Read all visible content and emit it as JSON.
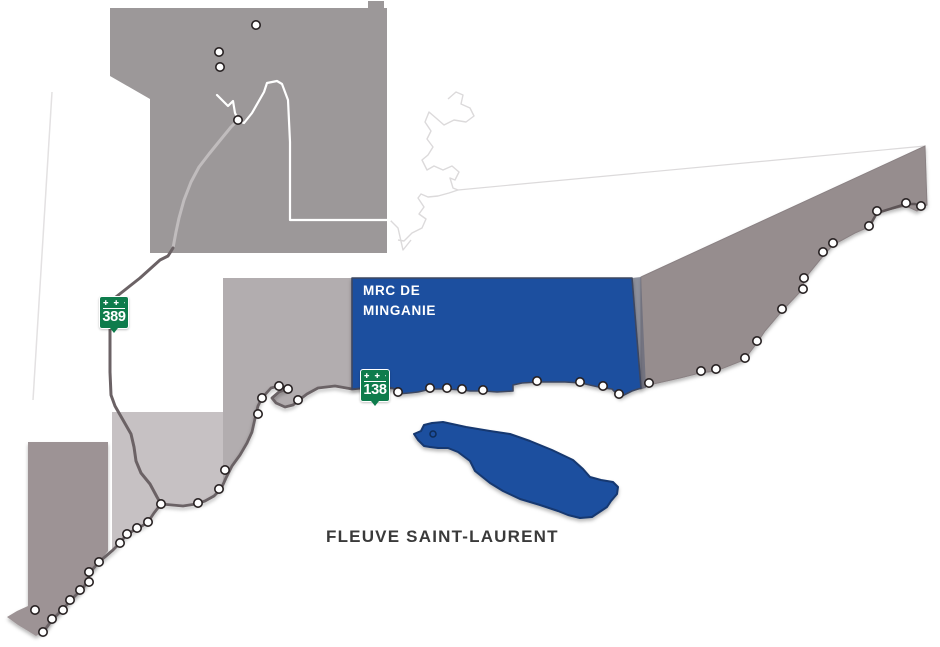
{
  "labels": {
    "region_line1": "MRC DE",
    "region_line2": "MINGANIE",
    "river": "FLEUVE SAINT-LAURENT"
  },
  "shields": [
    {
      "number": "389",
      "crosses": "✚ ✚ ✚"
    },
    {
      "number": "138",
      "crosses": "✚ ✚ ✚"
    }
  ],
  "colors": {
    "highlight_blue": "#1d4f9f",
    "island_blue": "#1d4f9f",
    "shield_green": "#0e7c4c",
    "north_region_gray": "#9c9899",
    "east_region_taupe": "#968d8e",
    "mid_region_gray": "#b2adaf",
    "light_region_gray": "#c6c1c3",
    "west_peninsula_taupe": "#9d9395",
    "road_dark": "#6b6265",
    "road_light": "#c0bcbd",
    "boundary_white": "#ffffff",
    "boundary_faint": "#dcdadb",
    "label_dark": "#3a3a3a",
    "label_white": "#ffffff"
  },
  "settlement_dots": {
    "north": [
      [
        256,
        25
      ],
      [
        219,
        52
      ],
      [
        220,
        67
      ],
      [
        238,
        120
      ]
    ],
    "minganie_coast": [
      [
        398,
        392
      ],
      [
        430,
        388
      ],
      [
        447,
        388
      ],
      [
        462,
        389
      ],
      [
        483,
        390
      ],
      [
        537,
        381
      ],
      [
        580,
        382
      ],
      [
        603,
        386
      ],
      [
        619,
        394
      ]
    ],
    "east_coast": [
      [
        649,
        383
      ],
      [
        701,
        371
      ],
      [
        716,
        369
      ],
      [
        745,
        358
      ],
      [
        757,
        341
      ],
      [
        782,
        309
      ],
      [
        803,
        289
      ],
      [
        804,
        278
      ],
      [
        823,
        252
      ],
      [
        833,
        243
      ],
      [
        869,
        226
      ],
      [
        877,
        211
      ],
      [
        906,
        203
      ],
      [
        921,
        206
      ]
    ],
    "central_coast": [
      [
        279,
        386
      ],
      [
        288,
        389
      ],
      [
        298,
        400
      ],
      [
        262,
        398
      ],
      [
        258,
        414
      ],
      [
        225,
        470
      ],
      [
        219,
        489
      ],
      [
        198,
        503
      ]
    ],
    "west_coast": [
      [
        161,
        504
      ],
      [
        148,
        522
      ],
      [
        137,
        528
      ],
      [
        127,
        534
      ],
      [
        120,
        543
      ],
      [
        99,
        562
      ],
      [
        89,
        572
      ],
      [
        89,
        582
      ],
      [
        80,
        590
      ],
      [
        70,
        600
      ],
      [
        63,
        610
      ],
      [
        52,
        619
      ],
      [
        43,
        632
      ],
      [
        35,
        610
      ]
    ],
    "island": [
      [
        433,
        434
      ]
    ]
  }
}
